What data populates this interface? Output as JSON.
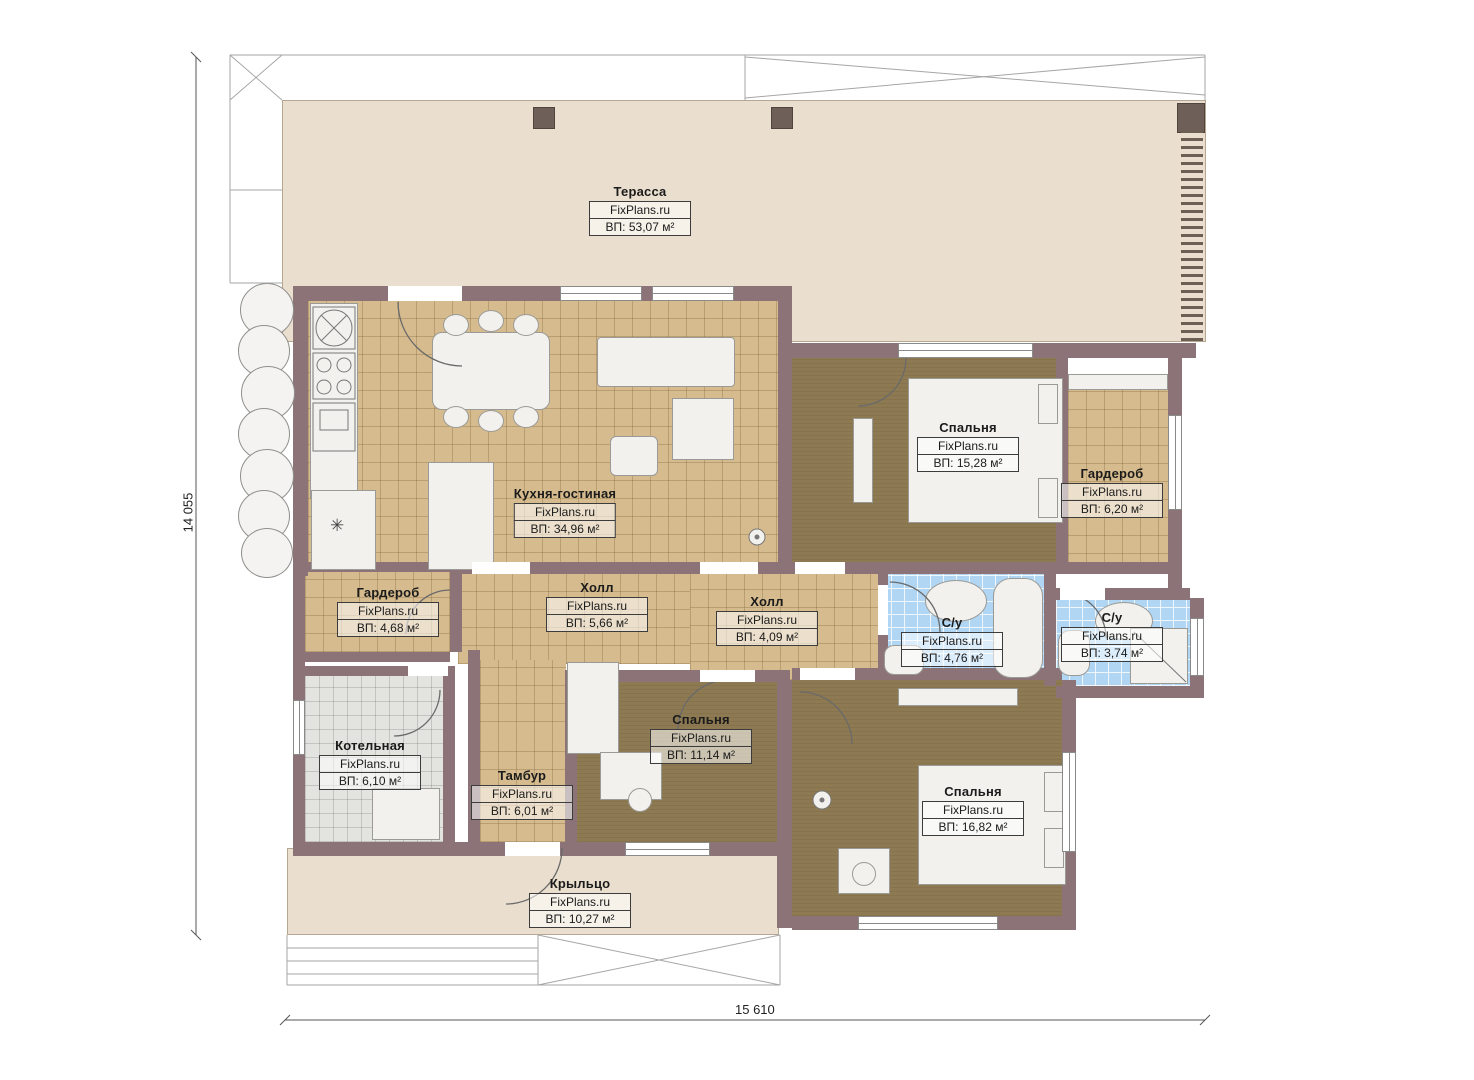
{
  "watermark": "FixPlans.ru",
  "dimensions": {
    "left": "14 055",
    "bottom": "15 610"
  },
  "rooms": [
    {
      "id": "terrace",
      "name": "Терасса",
      "area": "ВП: 53,07 м²"
    },
    {
      "id": "kitchen",
      "name": "Кухня-гостиная",
      "area": "ВП: 34,96 м²"
    },
    {
      "id": "bedroom1",
      "name": "Спальня",
      "area": "ВП: 15,28 м²"
    },
    {
      "id": "wardrobe1",
      "name": "Гардероб",
      "area": "ВП: 6,20 м²"
    },
    {
      "id": "hall1",
      "name": "Холл",
      "area": "ВП: 5,66 м²"
    },
    {
      "id": "hall2",
      "name": "Холл",
      "area": "ВП: 4,09 м²"
    },
    {
      "id": "wardrobe2",
      "name": "Гардероб",
      "area": "ВП: 4,68 м²"
    },
    {
      "id": "bath1",
      "name": "С/у",
      "area": "ВП: 4,76 м²"
    },
    {
      "id": "bath2",
      "name": "С/у",
      "area": "ВП: 3,74 м²"
    },
    {
      "id": "boiler",
      "name": "Котельная",
      "area": "ВП: 6,10 м²"
    },
    {
      "id": "vestibule",
      "name": "Тамбур",
      "area": "ВП: 6,01 м²"
    },
    {
      "id": "bedroom2",
      "name": "Спальня",
      "area": "ВП: 11,14 м²"
    },
    {
      "id": "bedroom3",
      "name": "Спальня",
      "area": "ВП: 16,82 м²"
    },
    {
      "id": "porch",
      "name": "Крыльцо",
      "area": "ВП: 10,27 м²"
    }
  ],
  "colors": {
    "wall": "#8b7377",
    "terrace_floor": "#eadfce",
    "tile_tan": "#d6bb8f",
    "carpet_brown": "#8e7a52",
    "tile_blue": "#b0d6f4",
    "tile_gray": "#e3e3e0",
    "furniture": "#f2f1ee"
  }
}
